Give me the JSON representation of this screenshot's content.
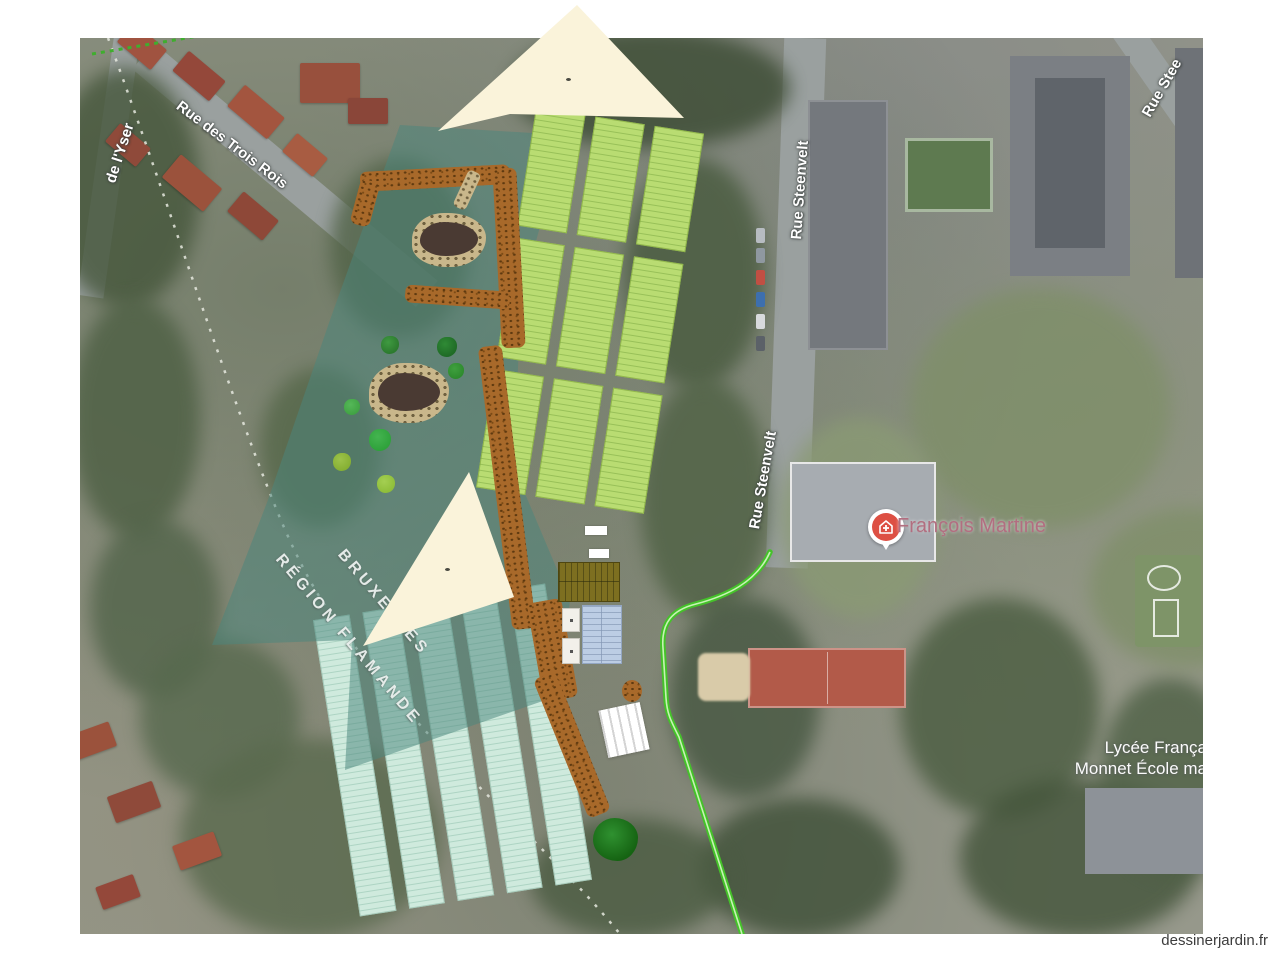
{
  "site": {
    "watermark": "dessinerjardin.fr"
  },
  "map": {
    "street_labels": [
      {
        "id": "yser",
        "text": "de l'Yser"
      },
      {
        "id": "trois-rois",
        "text": "Rue des Trois Rois"
      },
      {
        "id": "steenvelt-north",
        "text": "Rue Steenvelt"
      },
      {
        "id": "steenvelt-mid",
        "text": "Rue Steenvelt"
      },
      {
        "id": "steenvelt-corner",
        "text": "Rue Stee"
      }
    ],
    "region_labels": [
      {
        "id": "bruxelles",
        "text": "BRUXELLES"
      },
      {
        "id": "flamande",
        "text": "RÉGION FLAMANDE"
      }
    ],
    "poi": {
      "name": "François Martine",
      "icon": "health-pin"
    },
    "school": {
      "line1": "Lycée França",
      "line2": "Monnet École ma"
    }
  },
  "design": {
    "colors": {
      "zone_teal": "#4a867d",
      "bed_green": "#b9dc72",
      "bed_mint": "#cfeadd",
      "path_brown": "#a8692a",
      "route_green": "#45c22a",
      "canopy_cream": "#faf3da",
      "pond_dark": "#4a3a33",
      "stone_beige": "#c9b78b",
      "olive_shed": "#7d6f20",
      "blue_shed": "#bccde4",
      "tree_green": "#156312",
      "poi_pin_red": "#dd4f43"
    },
    "top_beds": {
      "groups": 3,
      "columns": 3
    },
    "bottom_beds": {
      "columns": 5
    }
  }
}
